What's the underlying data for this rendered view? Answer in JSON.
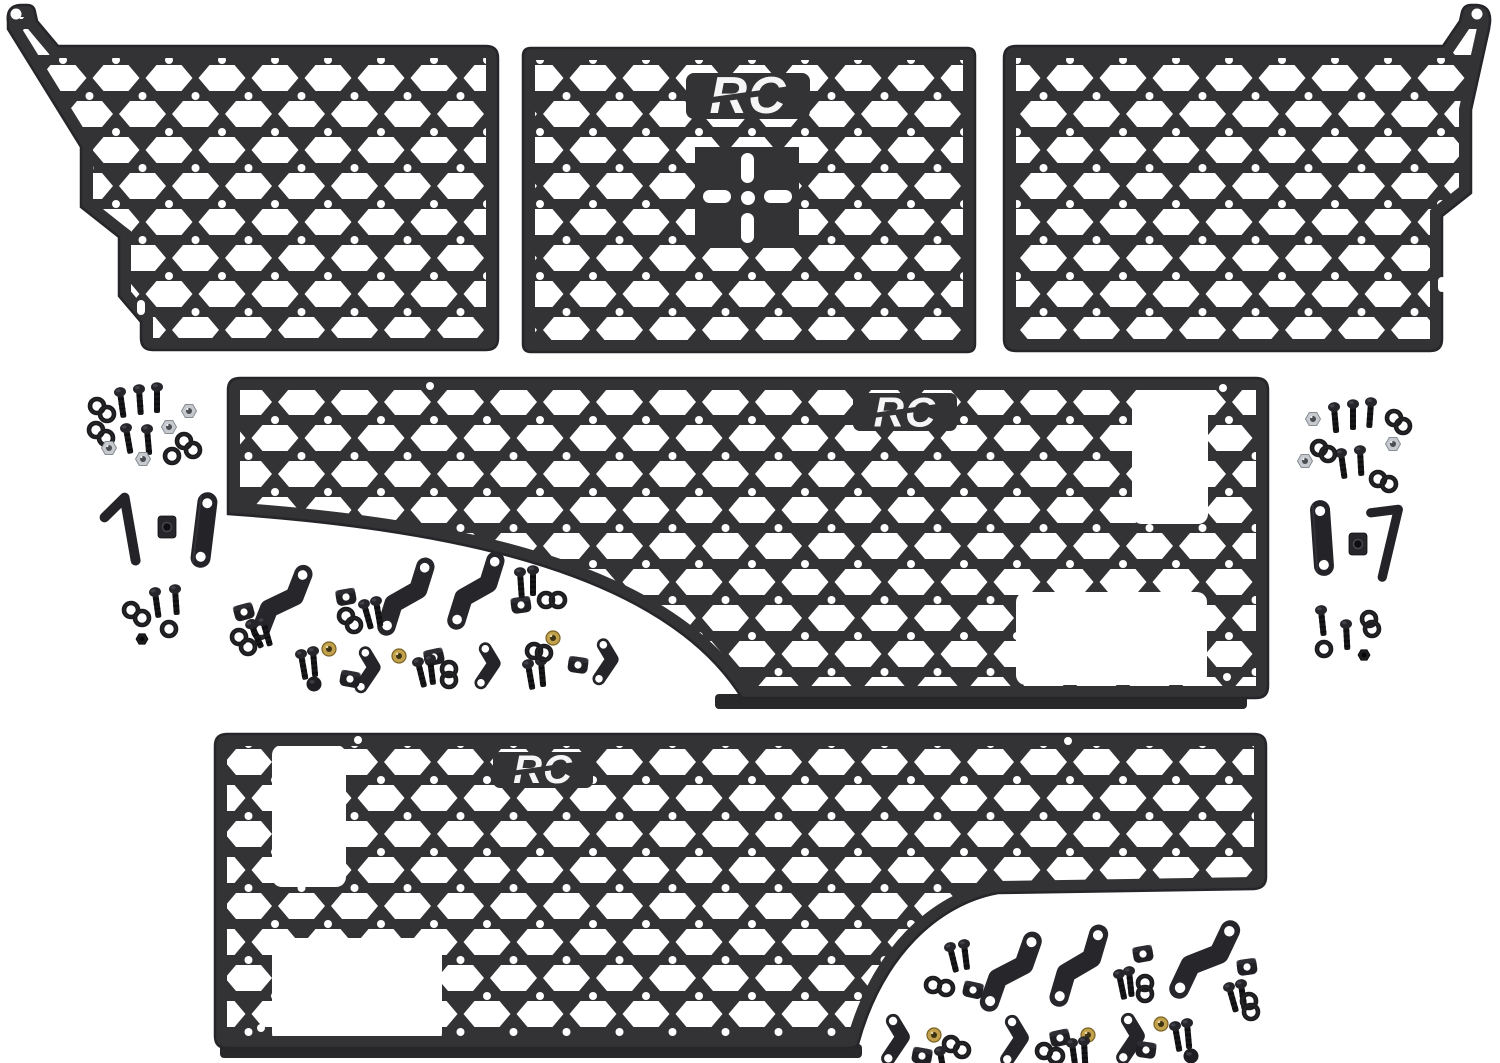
{
  "colors": {
    "background": "#ffffff",
    "panel": "#333336",
    "panel_border": "#26262a",
    "flange": "#28282b",
    "hardware": "#202024",
    "silver": "#c6cacf",
    "brass": "#c2a14c",
    "logo": "#f5f5f5"
  },
  "panels": [
    {
      "id": "top-left-molle-panel",
      "logo": ""
    },
    {
      "id": "top-center-molle-panel",
      "logo": "RC"
    },
    {
      "id": "top-right-molle-panel",
      "logo": ""
    },
    {
      "id": "middle-bed-side-panel",
      "logo": "RC"
    },
    {
      "id": "bottom-bed-side-panel",
      "logo": "RC"
    }
  ],
  "hardware": {
    "items": [
      {
        "t": "washer",
        "x": 97,
        "y": 406
      },
      {
        "t": "washer",
        "x": 107,
        "y": 414
      },
      {
        "t": "washer",
        "x": 96,
        "y": 430
      },
      {
        "t": "washer",
        "x": 106,
        "y": 438
      },
      {
        "t": "bolt",
        "x": 120,
        "y": 392,
        "r": -8
      },
      {
        "t": "bolt",
        "x": 139,
        "y": 389,
        "r": -4
      },
      {
        "t": "bolt",
        "x": 157,
        "y": 387
      },
      {
        "t": "bolt",
        "x": 126,
        "y": 428,
        "r": -10
      },
      {
        "t": "bolt",
        "x": 147,
        "y": 429,
        "r": -5
      },
      {
        "t": "nut-silver",
        "x": 189,
        "y": 411
      },
      {
        "t": "nut-silver",
        "x": 169,
        "y": 427
      },
      {
        "t": "nut-silver",
        "x": 109,
        "y": 448
      },
      {
        "t": "nut-silver",
        "x": 143,
        "y": 459
      },
      {
        "t": "washer",
        "x": 184,
        "y": 441
      },
      {
        "t": "washer",
        "x": 193,
        "y": 450
      },
      {
        "t": "washer",
        "x": 172,
        "y": 456
      },
      {
        "t": "lbracket",
        "x": 130,
        "y": 528,
        "r": -6,
        "s": 1.1
      },
      {
        "t": "block",
        "x": 167,
        "y": 527
      },
      {
        "t": "strap",
        "x": 204,
        "y": 530,
        "r": 7
      },
      {
        "t": "washer",
        "x": 131,
        "y": 610
      },
      {
        "t": "washer",
        "x": 142,
        "y": 618
      },
      {
        "t": "bolt",
        "x": 155,
        "y": 592,
        "r": -8
      },
      {
        "t": "bolt",
        "x": 175,
        "y": 589,
        "r": -4
      },
      {
        "t": "washer",
        "x": 169,
        "y": 629
      },
      {
        "t": "nut-dark",
        "x": 142,
        "y": 639
      },
      {
        "t": "zlong",
        "x": 283,
        "y": 602,
        "r": 38,
        "s": 1.15
      },
      {
        "t": "zlong",
        "x": 407,
        "y": 596,
        "r": 34,
        "s": 1.15
      },
      {
        "t": "zlong",
        "x": 477,
        "y": 590,
        "r": 34,
        "s": 1.15
      },
      {
        "t": "zsmall",
        "x": 368,
        "y": 671,
        "r": 14
      },
      {
        "t": "zsmall",
        "x": 488,
        "y": 667,
        "r": 14
      },
      {
        "t": "zsmall",
        "x": 606,
        "y": 663,
        "r": 14
      },
      {
        "t": "clamp",
        "x": 244,
        "y": 612,
        "r": -15
      },
      {
        "t": "clamp",
        "x": 346,
        "y": 597,
        "r": -10
      },
      {
        "t": "clamp",
        "x": 350,
        "y": 679,
        "r": 10
      },
      {
        "t": "clamp",
        "x": 434,
        "y": 657,
        "r": -12
      },
      {
        "t": "clamp",
        "x": 521,
        "y": 605,
        "r": -8
      },
      {
        "t": "clamp",
        "x": 578,
        "y": 665,
        "r": 8
      },
      {
        "t": "bolt",
        "x": 251,
        "y": 624,
        "r": -24
      },
      {
        "t": "bolt",
        "x": 263,
        "y": 621,
        "r": -16
      },
      {
        "t": "bolt",
        "x": 364,
        "y": 604,
        "r": -16
      },
      {
        "t": "bolt",
        "x": 376,
        "y": 601,
        "r": -10
      },
      {
        "t": "bolt",
        "x": 418,
        "y": 662,
        "r": -14
      },
      {
        "t": "bolt",
        "x": 430,
        "y": 659,
        "r": -7
      },
      {
        "t": "bolt",
        "x": 520,
        "y": 572,
        "r": -4
      },
      {
        "t": "bolt",
        "x": 533,
        "y": 570
      },
      {
        "t": "bolt",
        "x": 528,
        "y": 664,
        "r": -10
      },
      {
        "t": "bolt",
        "x": 541,
        "y": 661,
        "r": -5
      },
      {
        "t": "bolt",
        "x": 301,
        "y": 654,
        "r": -10
      },
      {
        "t": "bolt",
        "x": 313,
        "y": 651,
        "r": -5
      },
      {
        "t": "washer",
        "x": 239,
        "y": 637
      },
      {
        "t": "washer",
        "x": 248,
        "y": 647
      },
      {
        "t": "washer",
        "x": 346,
        "y": 616
      },
      {
        "t": "washer",
        "x": 354,
        "y": 625
      },
      {
        "t": "washer",
        "x": 546,
        "y": 600
      },
      {
        "t": "washer",
        "x": 558,
        "y": 600
      },
      {
        "t": "washer",
        "x": 534,
        "y": 651
      },
      {
        "t": "washer",
        "x": 544,
        "y": 653
      },
      {
        "t": "washer",
        "x": 449,
        "y": 669
      },
      {
        "t": "washer",
        "x": 449,
        "y": 680
      },
      {
        "t": "nut-brass",
        "x": 329,
        "y": 649
      },
      {
        "t": "nut-brass",
        "x": 399,
        "y": 656
      },
      {
        "t": "nut-brass",
        "x": 553,
        "y": 638
      },
      {
        "t": "dome",
        "x": 314,
        "y": 684
      },
      {
        "t": "nut-silver",
        "x": 1313,
        "y": 419
      },
      {
        "t": "nut-silver",
        "x": 1305,
        "y": 461
      },
      {
        "t": "nut-silver",
        "x": 1393,
        "y": 444
      },
      {
        "t": "bolt",
        "x": 1334,
        "y": 407,
        "r": -5
      },
      {
        "t": "bolt",
        "x": 1353,
        "y": 404
      },
      {
        "t": "bolt",
        "x": 1371,
        "y": 402,
        "r": 4
      },
      {
        "t": "bolt",
        "x": 1341,
        "y": 453,
        "r": -8
      },
      {
        "t": "bolt",
        "x": 1360,
        "y": 450,
        "r": -3
      },
      {
        "t": "washer",
        "x": 1394,
        "y": 418
      },
      {
        "t": "washer",
        "x": 1403,
        "y": 426
      },
      {
        "t": "washer",
        "x": 1319,
        "y": 448
      },
      {
        "t": "washer",
        "x": 1328,
        "y": 454
      },
      {
        "t": "washer",
        "x": 1378,
        "y": 479
      },
      {
        "t": "washer",
        "x": 1389,
        "y": 484
      },
      {
        "t": "strap",
        "x": 1322,
        "y": 538,
        "r": -4
      },
      {
        "t": "block",
        "x": 1358,
        "y": 544
      },
      {
        "t": "anglekey",
        "x": 1388,
        "y": 545,
        "s": 1.15
      },
      {
        "t": "bolt",
        "x": 1321,
        "y": 610,
        "r": -6
      },
      {
        "t": "bolt",
        "x": 1346,
        "y": 624,
        "r": -3
      },
      {
        "t": "washer",
        "x": 1369,
        "y": 619
      },
      {
        "t": "washer",
        "x": 1372,
        "y": 629
      },
      {
        "t": "washer",
        "x": 1324,
        "y": 649
      },
      {
        "t": "nut-dark",
        "x": 1364,
        "y": 655
      },
      {
        "t": "bolt",
        "x": 950,
        "y": 947,
        "r": -14
      },
      {
        "t": "bolt",
        "x": 964,
        "y": 944,
        "r": -7
      },
      {
        "t": "washer",
        "x": 933,
        "y": 985
      },
      {
        "t": "washer",
        "x": 946,
        "y": 988
      },
      {
        "t": "clamp",
        "x": 973,
        "y": 990,
        "r": 12
      },
      {
        "t": "zlong",
        "x": 1012,
        "y": 971,
        "r": 36,
        "s": 1.2
      },
      {
        "t": "zlong",
        "x": 1080,
        "y": 965,
        "r": 33,
        "s": 1.2
      },
      {
        "t": "zlong",
        "x": 1206,
        "y": 959,
        "r": 42,
        "s": 1.25
      },
      {
        "t": "clamp",
        "x": 1143,
        "y": 954,
        "r": -10
      },
      {
        "t": "clamp",
        "x": 1247,
        "y": 967,
        "r": -8
      },
      {
        "t": "bolt",
        "x": 1119,
        "y": 974,
        "r": -12
      },
      {
        "t": "bolt",
        "x": 1129,
        "y": 971,
        "r": -6
      },
      {
        "t": "washer",
        "x": 1145,
        "y": 983
      },
      {
        "t": "washer",
        "x": 1145,
        "y": 994
      },
      {
        "t": "bolt",
        "x": 1229,
        "y": 987,
        "r": -16
      },
      {
        "t": "bolt",
        "x": 1241,
        "y": 984,
        "r": -8
      },
      {
        "t": "washer",
        "x": 1249,
        "y": 1001
      },
      {
        "t": "washer",
        "x": 1251,
        "y": 1012
      },
      {
        "t": "zsmall",
        "x": 896,
        "y": 1041,
        "r": 14,
        "s": 1.1
      },
      {
        "t": "zsmall",
        "x": 1015,
        "y": 1042,
        "r": 14,
        "s": 1.1
      },
      {
        "t": "zsmall",
        "x": 1131,
        "y": 1040,
        "r": 14,
        "s": 1.1
      },
      {
        "t": "nut-brass",
        "x": 934,
        "y": 1035
      },
      {
        "t": "nut-brass",
        "x": 1088,
        "y": 1035
      },
      {
        "t": "nut-brass",
        "x": 1161,
        "y": 1024
      },
      {
        "t": "washer",
        "x": 951,
        "y": 1044
      },
      {
        "t": "washer",
        "x": 962,
        "y": 1050
      },
      {
        "t": "washer",
        "x": 1044,
        "y": 1051
      },
      {
        "t": "washer",
        "x": 1056,
        "y": 1056
      },
      {
        "t": "clamp",
        "x": 922,
        "y": 1056,
        "r": 10
      },
      {
        "t": "clamp",
        "x": 1060,
        "y": 1038,
        "r": -12
      },
      {
        "t": "clamp",
        "x": 1146,
        "y": 1050,
        "r": 8
      },
      {
        "t": "bolt",
        "x": 940,
        "y": 1051,
        "r": -10
      },
      {
        "t": "bolt",
        "x": 1072,
        "y": 1043,
        "r": -8
      },
      {
        "t": "bolt",
        "x": 1084,
        "y": 1041,
        "r": -3
      },
      {
        "t": "bolt",
        "x": 1175,
        "y": 1026,
        "r": -10
      },
      {
        "t": "bolt",
        "x": 1187,
        "y": 1023,
        "r": -5
      },
      {
        "t": "dome",
        "x": 1191,
        "y": 1056
      }
    ]
  }
}
